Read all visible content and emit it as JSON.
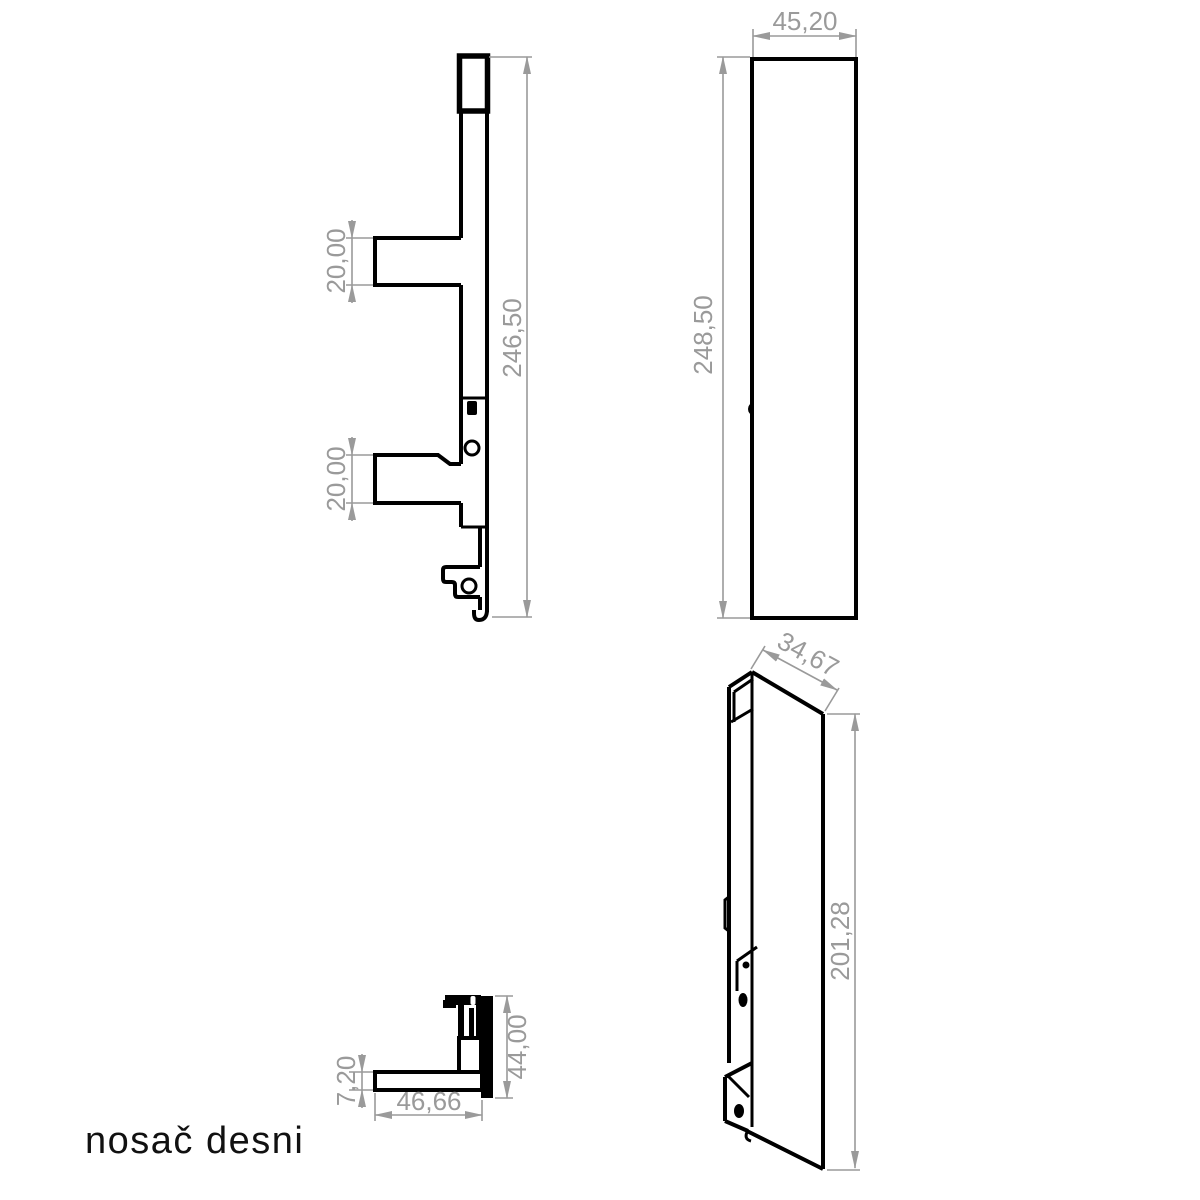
{
  "title": "nosač desni",
  "colors": {
    "part_line": "#000000",
    "dimension": "#9a9a9a",
    "background": "#ffffff"
  },
  "views": {
    "side": {
      "label": "side view",
      "dims": {
        "pin_top": "20,00",
        "pin_bottom": "20,00",
        "length": "246,50"
      }
    },
    "front": {
      "label": "front view",
      "dims": {
        "width": "45,20",
        "height": "248,50"
      }
    },
    "top": {
      "label": "top view",
      "dims": {
        "thickness": "7,20",
        "width": "46,66",
        "height": "44,00"
      }
    },
    "iso": {
      "label": "isometric view",
      "dims": {
        "depth": "34,67",
        "height": "201,28"
      }
    }
  }
}
